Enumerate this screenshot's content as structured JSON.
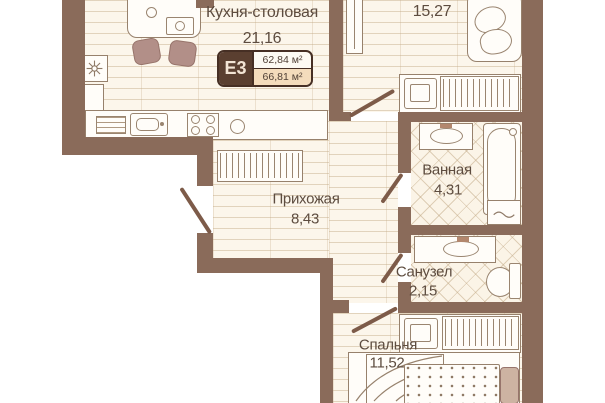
{
  "badge": {
    "type": "Е3",
    "area_row1": "62,84 м²",
    "area_row2": "66,81 м²"
  },
  "rooms": {
    "kitchen": {
      "name": "Кухня-столовая",
      "area": "21,16"
    },
    "living": {
      "area": "15,27"
    },
    "bathroom": {
      "name": "Ванная",
      "area": "4,31"
    },
    "hallway": {
      "name": "Прихожая",
      "area": "8,43"
    },
    "wc": {
      "name": "Санузел",
      "area": "2,15"
    },
    "bedroom": {
      "name": "Спальня",
      "area": "11,52"
    }
  },
  "colors": {
    "wall": "#8a6b5a",
    "floor": "#fcf6eb",
    "badge_dark": "#5a3f30",
    "badge_row2_bg": "#f4dcbc",
    "text": "#5d4c3f"
  },
  "icons": {
    "ventilation": "fan-cross",
    "hanger_wardrobe": "vertical-hatch-lines",
    "laundry": "water-wave"
  }
}
